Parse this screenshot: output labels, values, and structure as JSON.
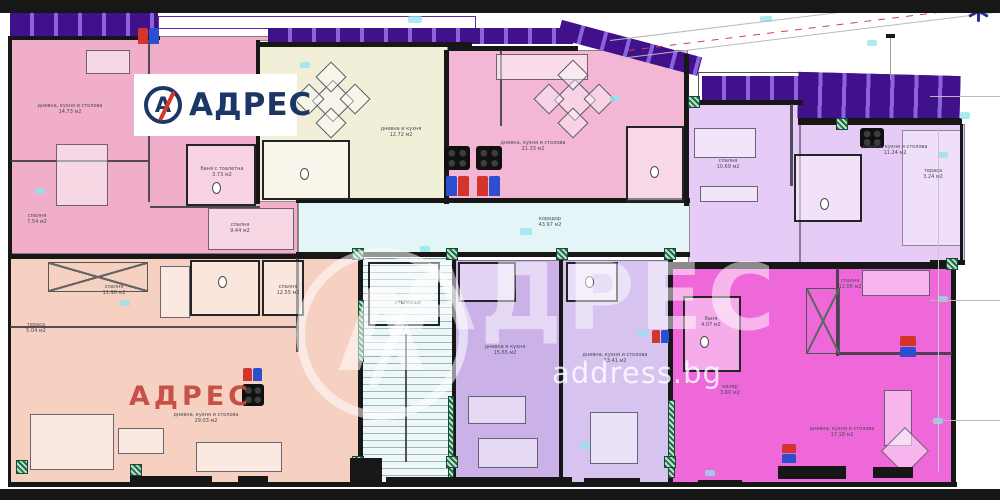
{
  "brand": {
    "logo_mark": "А",
    "logo_text": "АДРЕС",
    "watermark_mark": "А",
    "watermark_text": "АДРЕС",
    "watermark_sub": "address.bg",
    "watermark_red": "АДРЕС"
  },
  "colors": {
    "unit_pink": "#f0aecb",
    "unit_cream": "#f2efd9",
    "unit_pink2": "#f3b6d4",
    "unit_lavender": "#e5cbf5",
    "unit_lavender_light": "#efdffb",
    "corridor_cyan": "#e3f5f6",
    "unit_peach": "#f6d1c1",
    "unit_lilac": "#cab1e8",
    "unit_lilac2": "#d7c3f0",
    "unit_magenta": "#ee68da",
    "balcony_purple": "#41118c",
    "balcony_purple_light": "#8a63dd",
    "wall_black": "#171717",
    "green_insulation": "#1e6b46",
    "marker_red": "#d3342c",
    "marker_blue": "#2b4fd0",
    "logo_navy": "#1c3766",
    "logo_red": "#d6362c",
    "watermark_red": "#c44a42"
  },
  "rooms": [
    {
      "label": "дневна, кухня и столова",
      "area": "14.73 м2"
    },
    {
      "label": "спалня",
      "area": "7.54 м2"
    },
    {
      "label": "спалня",
      "area": "9.44 м2"
    },
    {
      "label": "дневна и кухня",
      "area": "12.72 м2"
    },
    {
      "label": "дневна, кухня и столова",
      "area": "21.33 м2"
    },
    {
      "label": "спалня",
      "area": "10.69 м2"
    },
    {
      "label": "дневна, кухня и столова",
      "area": "11.24 м2"
    },
    {
      "label": "тераса",
      "area": "3.24 м2"
    },
    {
      "label": "коридор",
      "area": "43.97 м2"
    },
    {
      "label": "спалня",
      "area": "11.96 м2"
    },
    {
      "label": "тераса",
      "area": "5.04 м2"
    },
    {
      "label": "спалня",
      "area": "12.55 м2"
    },
    {
      "label": "дневна, кухня и столова",
      "area": "29.03 м2"
    },
    {
      "label": "дневна и кухня",
      "area": "15.65 м2"
    },
    {
      "label": "дневна, кухня и столова",
      "area": "13.41 м2"
    },
    {
      "label": "спалня",
      "area": "12.06 м2"
    },
    {
      "label": "килер",
      "area": "3.60 м2"
    },
    {
      "label": "дневна, кухня и столова",
      "area": "17.18 м2"
    },
    {
      "label": "баня",
      "area": "4.07 м2"
    },
    {
      "label": "баня с тоалетна",
      "area": "3.73 м2"
    },
    {
      "label": "стълбище",
      "area": ""
    }
  ]
}
